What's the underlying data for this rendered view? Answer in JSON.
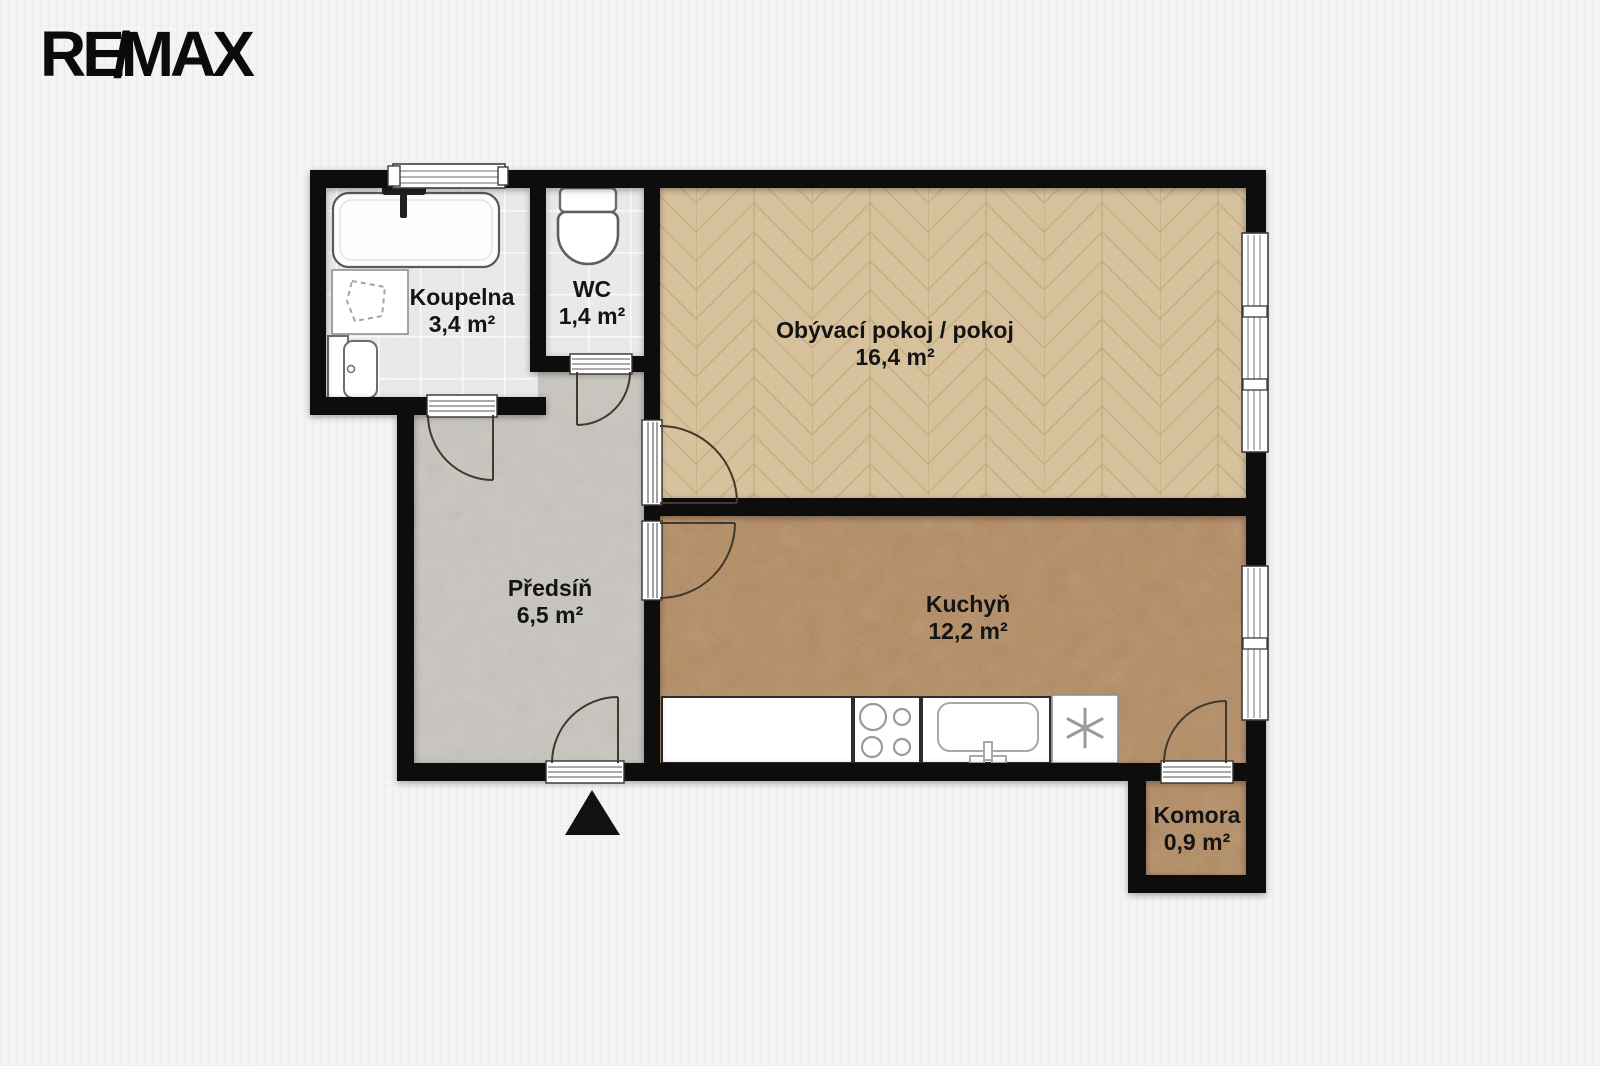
{
  "logo": {
    "re": "RE",
    "slash": "/",
    "max": "MAX"
  },
  "rooms": [
    {
      "name": "Koupelna",
      "area": "3,4 m²"
    },
    {
      "name": "WC",
      "area": "1,4 m²"
    },
    {
      "name": "Obývací pokoj / pokoj",
      "area": "16,4 m²"
    },
    {
      "name": "Předsíň",
      "area": "6,5 m²"
    },
    {
      "name": "Kuchyň",
      "area": "12,2 m²"
    },
    {
      "name": "Komora",
      "area": "0,9 m²"
    }
  ],
  "colors": {
    "wall": "#111111",
    "background": "#f4f4f5",
    "bath_tile": "#e9ebea",
    "hall_floor": "#c9c6bf",
    "living_floor": "#d8c29c",
    "kitchen_floor": "#b3885c",
    "logo": "#0b0b0b"
  }
}
